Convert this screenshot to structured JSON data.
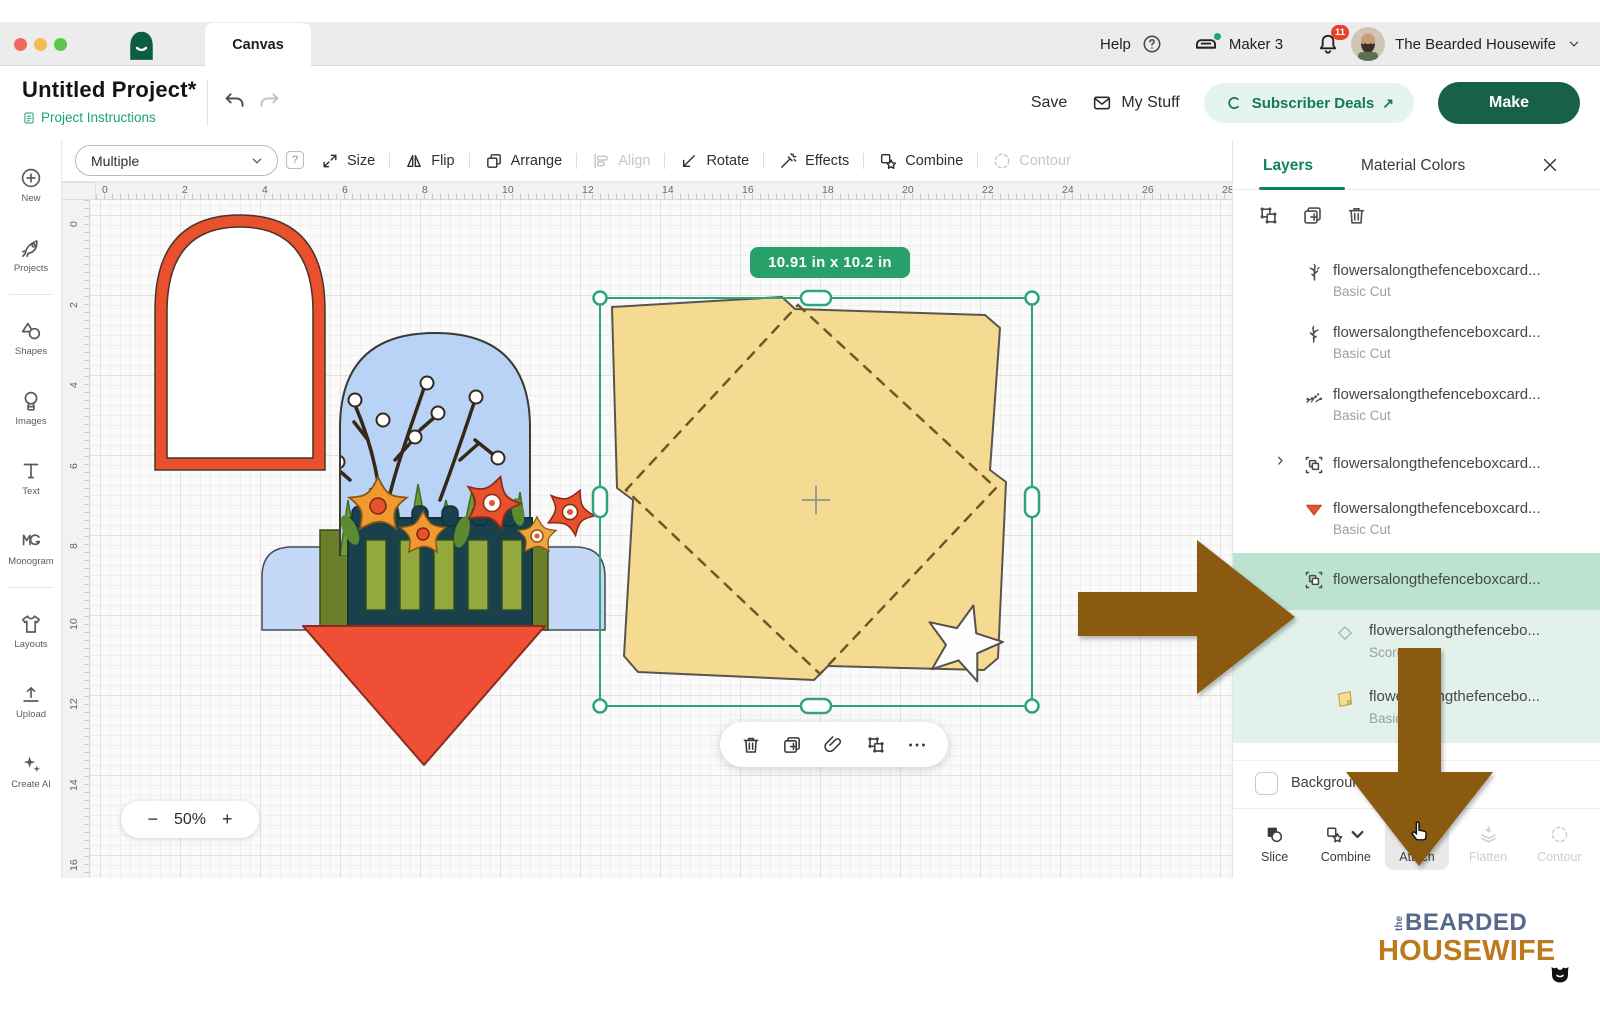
{
  "titlebar": {
    "tab": "Canvas",
    "help_label": "Help",
    "device_label": "Maker 3",
    "notification_count": "11",
    "account_name": "The Bearded Housewife"
  },
  "header": {
    "project_title": "Untitled Project*",
    "project_instructions_label": "Project Instructions",
    "save_label": "Save",
    "my_stuff_label": "My Stuff",
    "subscriber_deals_label": "Subscriber Deals",
    "deals_arrow": "↗",
    "make_label": "Make"
  },
  "toolbar": {
    "selection_value": "Multiple",
    "help_badge": "?",
    "items": [
      {
        "label": "Size",
        "icon": "size",
        "enabled": true
      },
      {
        "label": "Flip",
        "icon": "flip",
        "enabled": true
      },
      {
        "label": "Arrange",
        "icon": "arrange",
        "enabled": true
      },
      {
        "label": "Align",
        "icon": "align",
        "enabled": false
      },
      {
        "label": "Rotate",
        "icon": "rotate",
        "enabled": true
      },
      {
        "label": "Effects",
        "icon": "effects",
        "enabled": true
      },
      {
        "label": "Combine",
        "icon": "combine",
        "enabled": true
      },
      {
        "label": "Contour",
        "icon": "contour",
        "enabled": false
      }
    ]
  },
  "sidebar": {
    "items": [
      {
        "label": "New",
        "icon": "new"
      },
      {
        "label": "Projects",
        "icon": "projects"
      },
      {
        "label": "Shapes",
        "icon": "shapes",
        "group_start": true
      },
      {
        "label": "Images",
        "icon": "images"
      },
      {
        "label": "Text",
        "icon": "text"
      },
      {
        "label": "Monogram",
        "icon": "monogram"
      },
      {
        "label": "Layouts",
        "icon": "layouts",
        "group_start": true
      },
      {
        "label": "Upload",
        "icon": "upload"
      },
      {
        "label": "Create AI",
        "icon": "createai"
      }
    ]
  },
  "canvas": {
    "size_badge": "10.91 in x 10.2 in",
    "zoom_value": "50%",
    "zoom_out": "−",
    "zoom_in": "+",
    "h_ruler": [
      "0",
      "2",
      "4",
      "6",
      "8",
      "10",
      "12",
      "14",
      "16",
      "18",
      "20",
      "22",
      "24",
      "26",
      "28"
    ],
    "v_ruler": [
      "0",
      "2",
      "4",
      "6",
      "8",
      "10",
      "12",
      "14",
      "16"
    ]
  },
  "layers_panel": {
    "tabs": [
      {
        "label": "Layers",
        "active": true
      },
      {
        "label": "Material Colors",
        "active": false
      }
    ],
    "layers": [
      {
        "icon": "twig",
        "name": "flowersalongthefenceboxcard...",
        "type": "Basic Cut"
      },
      {
        "icon": "twig2",
        "name": "flowersalongthefenceboxcard...",
        "type": "Basic Cut"
      },
      {
        "icon": "flowers",
        "name": "flowersalongthefenceboxcard...",
        "type": "Basic Cut"
      },
      {
        "icon": "group",
        "name": "flowersalongthefenceboxcard...",
        "collapsed": true
      },
      {
        "icon": "triangle",
        "name": "flowersalongthefenceboxcard...",
        "type": "Basic Cut"
      },
      {
        "icon": "group",
        "name": "flowersalongthefenceboxcard...",
        "selected": true
      },
      {
        "icon": "diamond",
        "name": "flowersalongthefencebo...",
        "type": "Score",
        "child": true
      },
      {
        "icon": "card",
        "name": "flowersalongthefencebo...",
        "type": "Basic Cut",
        "child": true
      }
    ],
    "background_label": "Background",
    "actions": [
      {
        "label": "Slice",
        "icon": "slice",
        "enabled": true
      },
      {
        "label": "Combine",
        "icon": "combineaction",
        "enabled": true,
        "dropdown": true
      },
      {
        "label": "Attach",
        "icon": "clip",
        "enabled": true,
        "active": true
      },
      {
        "label": "Flatten",
        "icon": "flatten",
        "enabled": false
      },
      {
        "label": "Contour",
        "icon": "contour",
        "enabled": false
      }
    ]
  },
  "watermark": {
    "prefix": "the",
    "line1": "BEARDED",
    "line2": "HOUSEWIFE"
  },
  "colors": {
    "brand_green": "#17604a",
    "selection_teal": "#2ea37e",
    "selected_row": "#bce3d0",
    "child_row": "#e2f1ea",
    "annotation_brown": "#8a5a10",
    "badge_green": "#27a169",
    "envelope_yellow": "#f5db92",
    "accent_red": "#ee4f35"
  }
}
